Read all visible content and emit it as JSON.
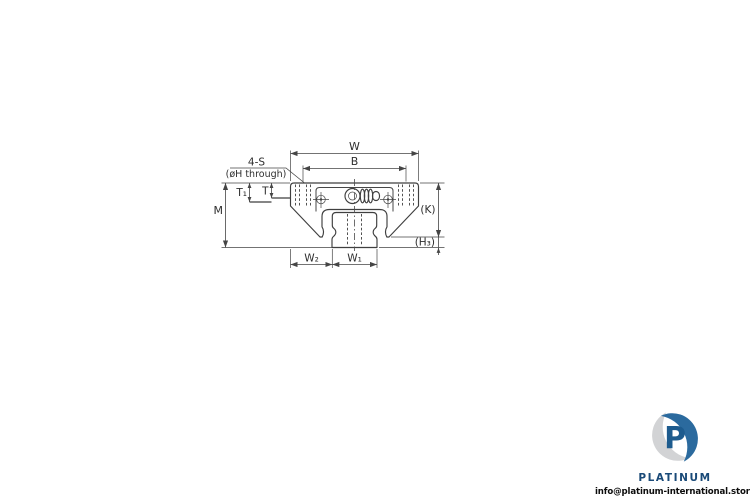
{
  "page": {
    "background": "#ffffff"
  },
  "drawing": {
    "type": "linear-guide-block-and-rail-cross-section",
    "line_color": "#3f3f3f",
    "text_color": "#2e2e2e",
    "labels": {
      "width": "W",
      "mount_spacing": "B",
      "screw_count": "4-S",
      "hole_note": "(øH through)",
      "t": "T",
      "t1": "T₁",
      "height": "M",
      "k": "(K)",
      "h3": "(H₃)",
      "w2": "W₂",
      "w1": "W₁"
    }
  },
  "logo": {
    "monogram": "P",
    "brand": "PLATINUM",
    "email": "info@platinum-international.store",
    "colors": {
      "blue": "#2b6a9e",
      "monogram_blue": "#1d5b8e",
      "wordmark_navy": "#1a4a78",
      "silver": "#d2d3d5"
    }
  }
}
